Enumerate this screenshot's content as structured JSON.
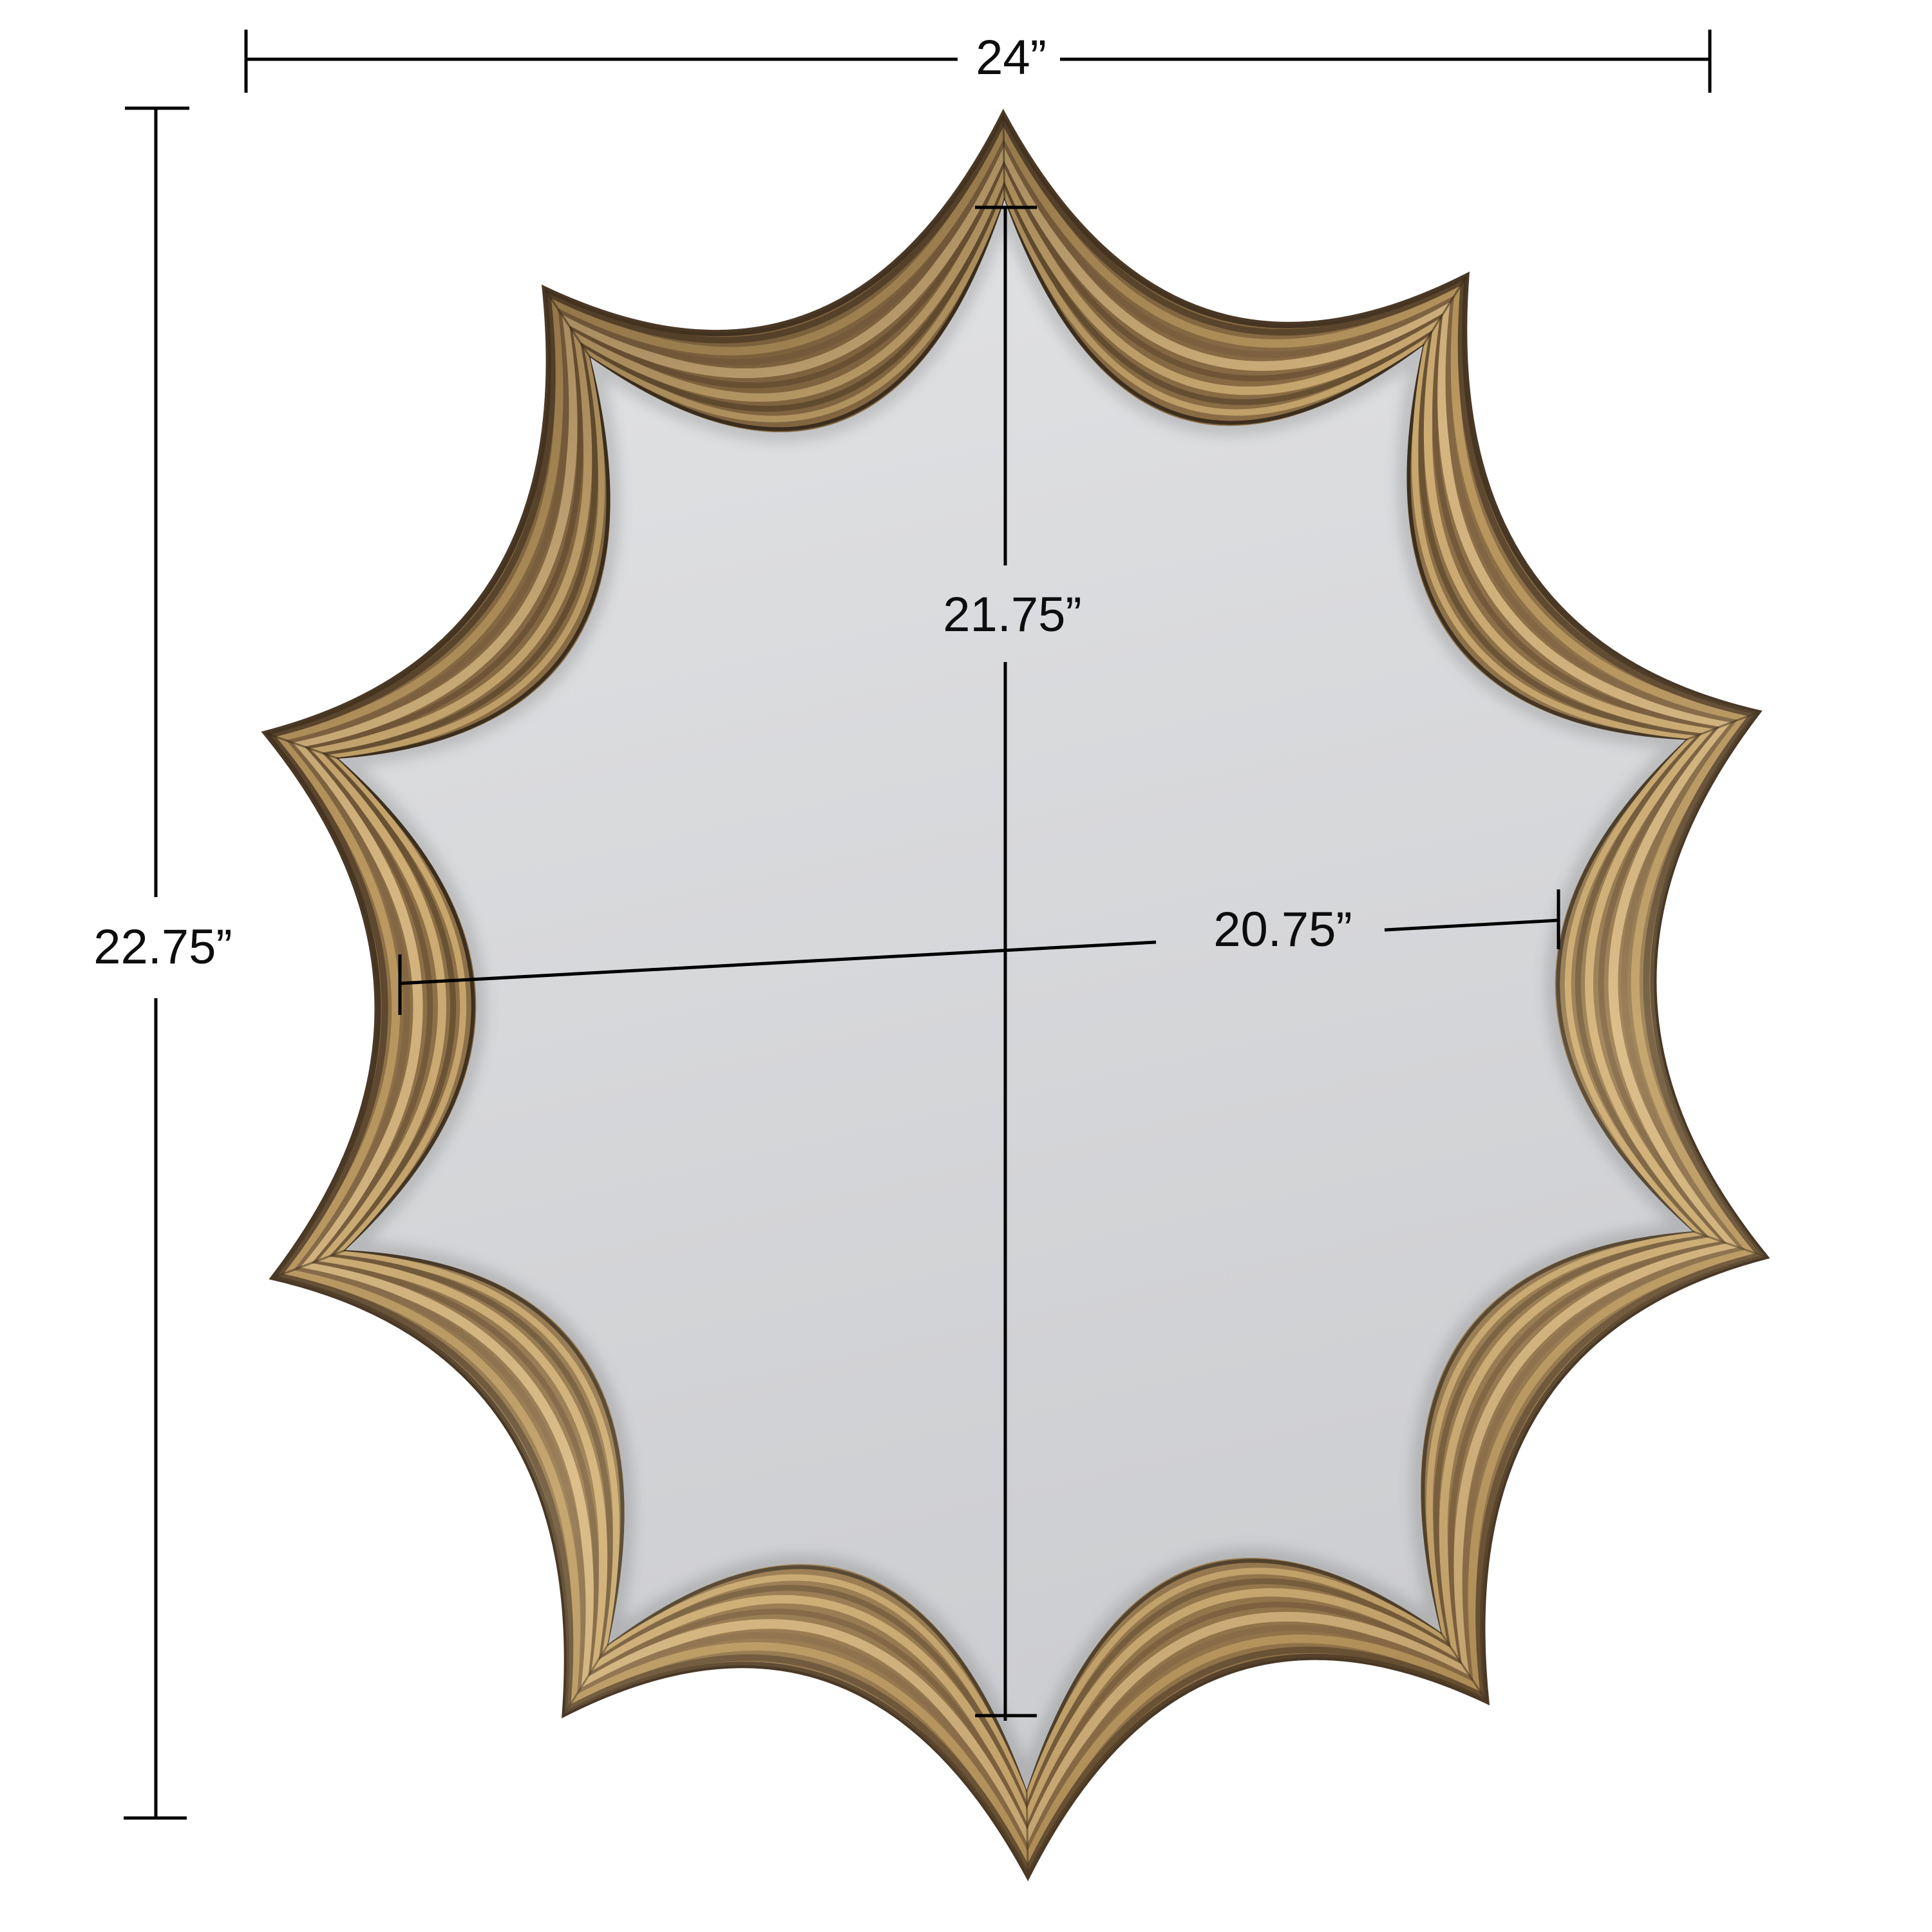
{
  "page": {
    "background": "#ffffff",
    "description": "dimension-diagram-of-scalloped-wall-mirror"
  },
  "dimensions": {
    "color": "#000000",
    "labels": {
      "overall_width": "24”",
      "overall_height": "22.75”",
      "glass_height": "21.75”",
      "glass_width": "20.75”"
    }
  },
  "mirror": {
    "glass_top": "#e1e2e4",
    "glass_bottom": "#cdced1",
    "frame_base": "#8f7148",
    "frame_outer_stroke": "#4a3826",
    "seam_color": "rgba(50,38,20,0.55)",
    "sheen_dark": "rgba(56,41,22,0.45)",
    "sheen_light": "rgba(246,226,180,0.20)",
    "sheen_bottom": "rgba(130,98,55,0.22)",
    "frame_ribs": [
      {
        "t": 0.03,
        "c": "#3b2e1f",
        "w": 6
      },
      {
        "t": 0.13,
        "c": "#c9a86e",
        "w": 10
      },
      {
        "t": 0.23,
        "c": "#6a5234",
        "w": 9
      },
      {
        "t": 0.34,
        "c": "#cfae74",
        "w": 13
      },
      {
        "t": 0.46,
        "c": "#75593a",
        "w": 9
      },
      {
        "t": 0.58,
        "c": "#d6b680",
        "w": 15
      },
      {
        "t": 0.69,
        "c": "#846744",
        "w": 10
      },
      {
        "t": 0.8,
        "c": "#bb9960",
        "w": 13
      },
      {
        "t": 0.91,
        "c": "#5e482f",
        "w": 10
      },
      {
        "t": 0.975,
        "c": "#463522",
        "w": 8
      }
    ]
  }
}
